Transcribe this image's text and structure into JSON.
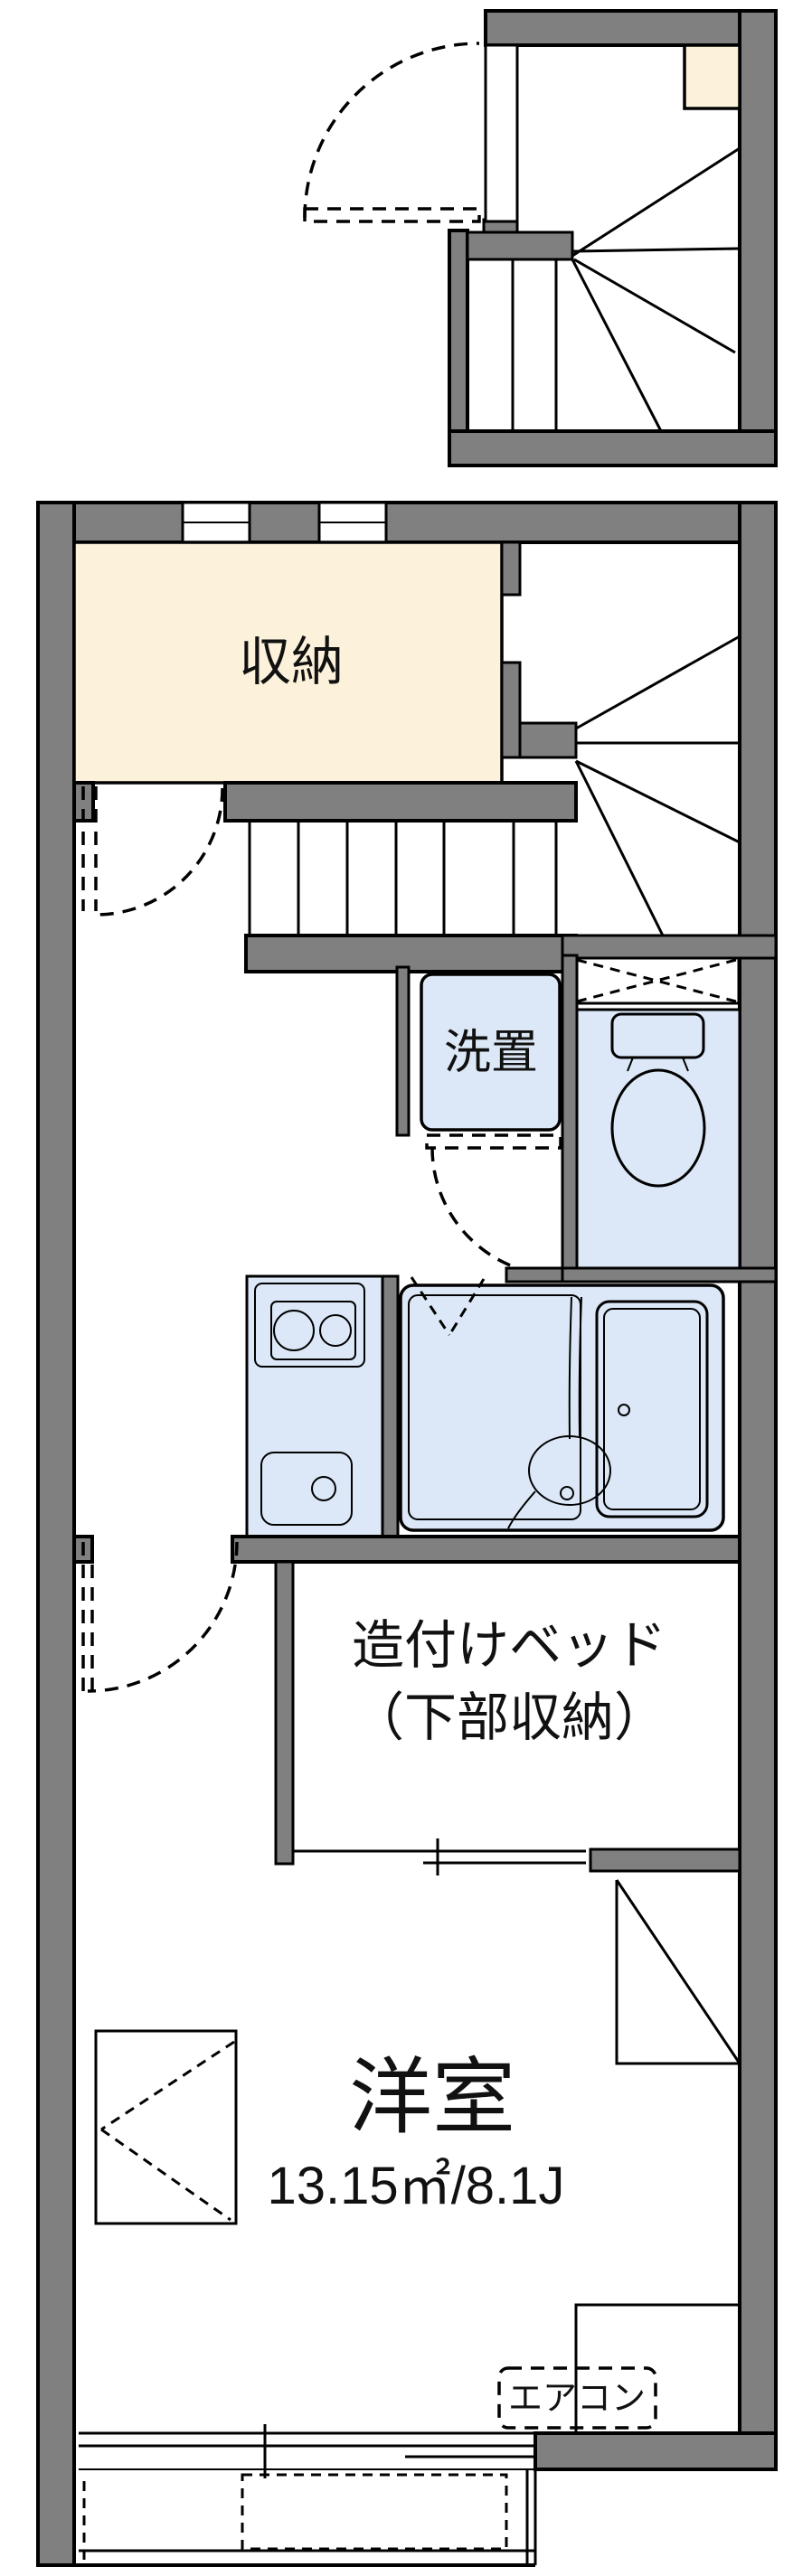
{
  "labels": {
    "storage": "収納",
    "washer": "洗置",
    "bed_line1": "造付けベッド",
    "bed_line2": "（下部収納）",
    "room_name": "洋室",
    "room_size": "13.15㎡/8.1J",
    "aircon": "エアコン"
  },
  "colors": {
    "wall": "#808080",
    "outline": "#000000",
    "storage_fill": "#fcf1da",
    "fixture_fill": "#dce8f7",
    "floor": "#ffffff"
  }
}
